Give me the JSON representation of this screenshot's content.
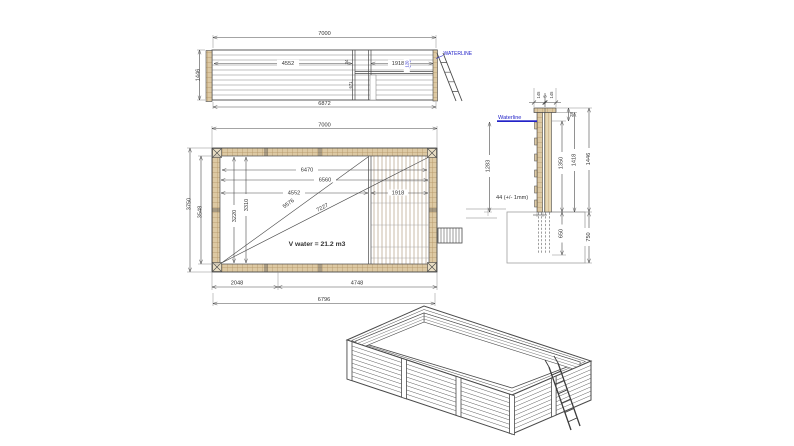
{
  "drawing_title": "Wooden pool technical drawing",
  "colors": {
    "line": "#4a4a4a",
    "wood": "#ddc9a3",
    "wood_line": "#b49467",
    "blue": "#2323c8",
    "ground": "#a0a0a0"
  },
  "elevation": {
    "dim_top": "7000",
    "dim_left": "1446",
    "dim_bottom": "6872",
    "dim_mid": "4552",
    "dim_right": "1918",
    "waterline_label": "WATERLINE",
    "dim_waterline_offset": "120",
    "dim_board": "34",
    "dim_panel": "671"
  },
  "plan": {
    "dim_top": "7000",
    "dim_left_outer": "3750",
    "dim_left_inner": "3548",
    "dim_inner_top": "6470",
    "dim_inner_2": "6560",
    "dim_inner_mid": "4552",
    "dim_right_panel": "1918",
    "dim_vert_1": "3310",
    "dim_vert_2": "3220",
    "dim_diag_1": "5576",
    "dim_diag_2": "7227",
    "volume_label": "V water = 21.2 m3",
    "dim_bottom_1": "2048",
    "dim_bottom_2": "4748",
    "dim_bottom_3": "6796"
  },
  "section": {
    "dim_cap_left": "145",
    "dim_cap_gap": "5",
    "dim_cap_right": "145",
    "dim_top_offset": "28",
    "dim_inner_height": "1350",
    "dim_mid_height": "1418",
    "dim_total_height": "1446",
    "waterline_label": "Waterline",
    "dim_water_depth": "1283",
    "plank_note": "44 (+/- 1mm)",
    "dim_below_inner": "650",
    "dim_below_outer": "750"
  }
}
